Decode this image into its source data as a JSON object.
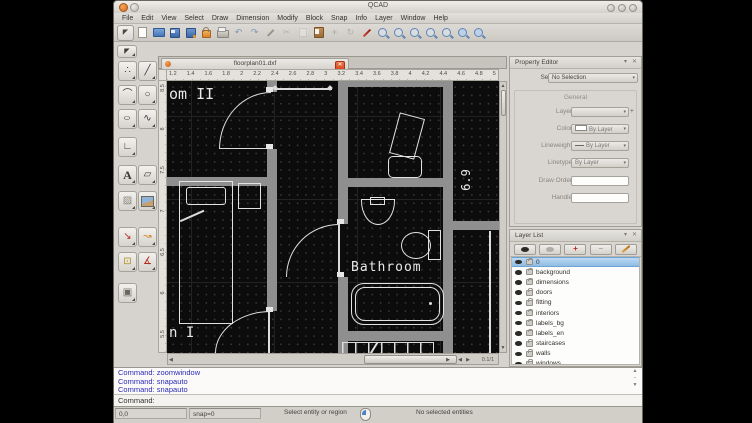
{
  "window": {
    "title": "QCAD"
  },
  "menu": {
    "items": [
      "File",
      "Edit",
      "View",
      "Select",
      "Draw",
      "Dimension",
      "Modify",
      "Block",
      "Snap",
      "Info",
      "Layer",
      "Window",
      "Help"
    ]
  },
  "icons": {
    "dropdown": "▾",
    "close": "✕",
    "collapse": "▾",
    "up": "▲",
    "down": "▼",
    "left": "◀",
    "right": "▶",
    "undo": "↶",
    "redo": "↷",
    "cut": "✂",
    "move": "+",
    "rotate": "↻",
    "plus": "+",
    "minus": "−",
    "pointer": "◤"
  },
  "toolbar": {
    "tools": [
      "selection",
      "new-file",
      "open-file",
      "save",
      "save-as",
      "lock",
      "print",
      "undo",
      "redo",
      "pen",
      "cut",
      "copy",
      "paste",
      "move",
      "rotate",
      "edit",
      "zoom-in",
      "zoom-out",
      "zoom-auto",
      "zoom-previous",
      "zoom-window",
      "zoom-pan",
      "zoom-redraw"
    ]
  },
  "palette": {
    "tools": [
      {
        "name": "point-tool",
        "glyph": "∴"
      },
      {
        "name": "line-tool",
        "glyph": "╱"
      },
      {
        "name": "arc-tool",
        "glyph": "⌒"
      },
      {
        "name": "circle-tool",
        "glyph": "○"
      },
      {
        "name": "ellipse-tool",
        "glyph": "○"
      },
      {
        "name": "spline-tool",
        "glyph": "∿"
      },
      {
        "name": "polyline-tool",
        "glyph": "∟"
      },
      {
        "name": "text-tool",
        "glyph": "A"
      },
      {
        "name": "shape-tool",
        "glyph": "▱"
      },
      {
        "name": "hatch-tool",
        "glyph": "▨"
      },
      {
        "name": "image-tool",
        "glyph": ""
      },
      {
        "name": "dimension-tool",
        "glyph": "↘"
      },
      {
        "name": "leader-tool",
        "glyph": "↝"
      },
      {
        "name": "block-tool",
        "glyph": "⊡"
      },
      {
        "name": "measure-tool",
        "glyph": "∡"
      },
      {
        "name": "solid-tool",
        "glyph": "▣"
      }
    ]
  },
  "doc": {
    "tab_title": "floorplan01.dxf",
    "ruler_h": [
      "1.2",
      "1.4",
      "1.6",
      "1.8",
      "2",
      "2.2",
      "2.4",
      "2.6",
      "2.8",
      "3",
      "3.2",
      "3.4",
      "3.6",
      "3.8",
      "4",
      "4.2",
      "4.4",
      "4.6",
      "4.8",
      "5"
    ],
    "ruler_v": [
      "8.5",
      "8",
      "7.5",
      "7",
      "6.5",
      "6",
      "5.5"
    ],
    "page_indicator": "0.1/1"
  },
  "canvas_labels": {
    "room2": "om II",
    "room1": "n I",
    "bathroom": "Bathroom",
    "dimension": "6.9"
  },
  "property_editor": {
    "title": "Property Editor",
    "selection_label": "Selection:",
    "selection_value": "No Selection",
    "group": "General",
    "rows": [
      {
        "label": "Layer:",
        "value": ""
      },
      {
        "label": "Color:",
        "value": "By Layer"
      },
      {
        "label": "Lineweight:",
        "value": "By Layer"
      },
      {
        "label": "Linetype:",
        "value": "By Layer"
      },
      {
        "label": "Draw Order:",
        "value": ""
      },
      {
        "label": "Handle:",
        "value": ""
      }
    ],
    "add_layer": "+"
  },
  "layer_list": {
    "title": "Layer List",
    "layers": [
      "0",
      "background",
      "dimensions",
      "doors",
      "fitting",
      "interiors",
      "labels_bg",
      "labels_en",
      "staircases",
      "walls",
      "windows"
    ],
    "selected": "0"
  },
  "command": {
    "history": [
      "Command: zoomwindow",
      "Command: snapauto",
      "Command: snapauto"
    ],
    "prompt": "Command:"
  },
  "status": {
    "coords": "0,0",
    "snap": "snap=0",
    "hint": "Select entity or region",
    "selection": "No selected entities"
  },
  "colors": {
    "accent_blue": "#5f85b4",
    "selection_row": "#9fc5e8",
    "wall_grey": "#8f8f8f",
    "canvas_bg": "#0c0c0c",
    "command_blue": "#2a2ab8",
    "close_red": "#d8441d"
  }
}
